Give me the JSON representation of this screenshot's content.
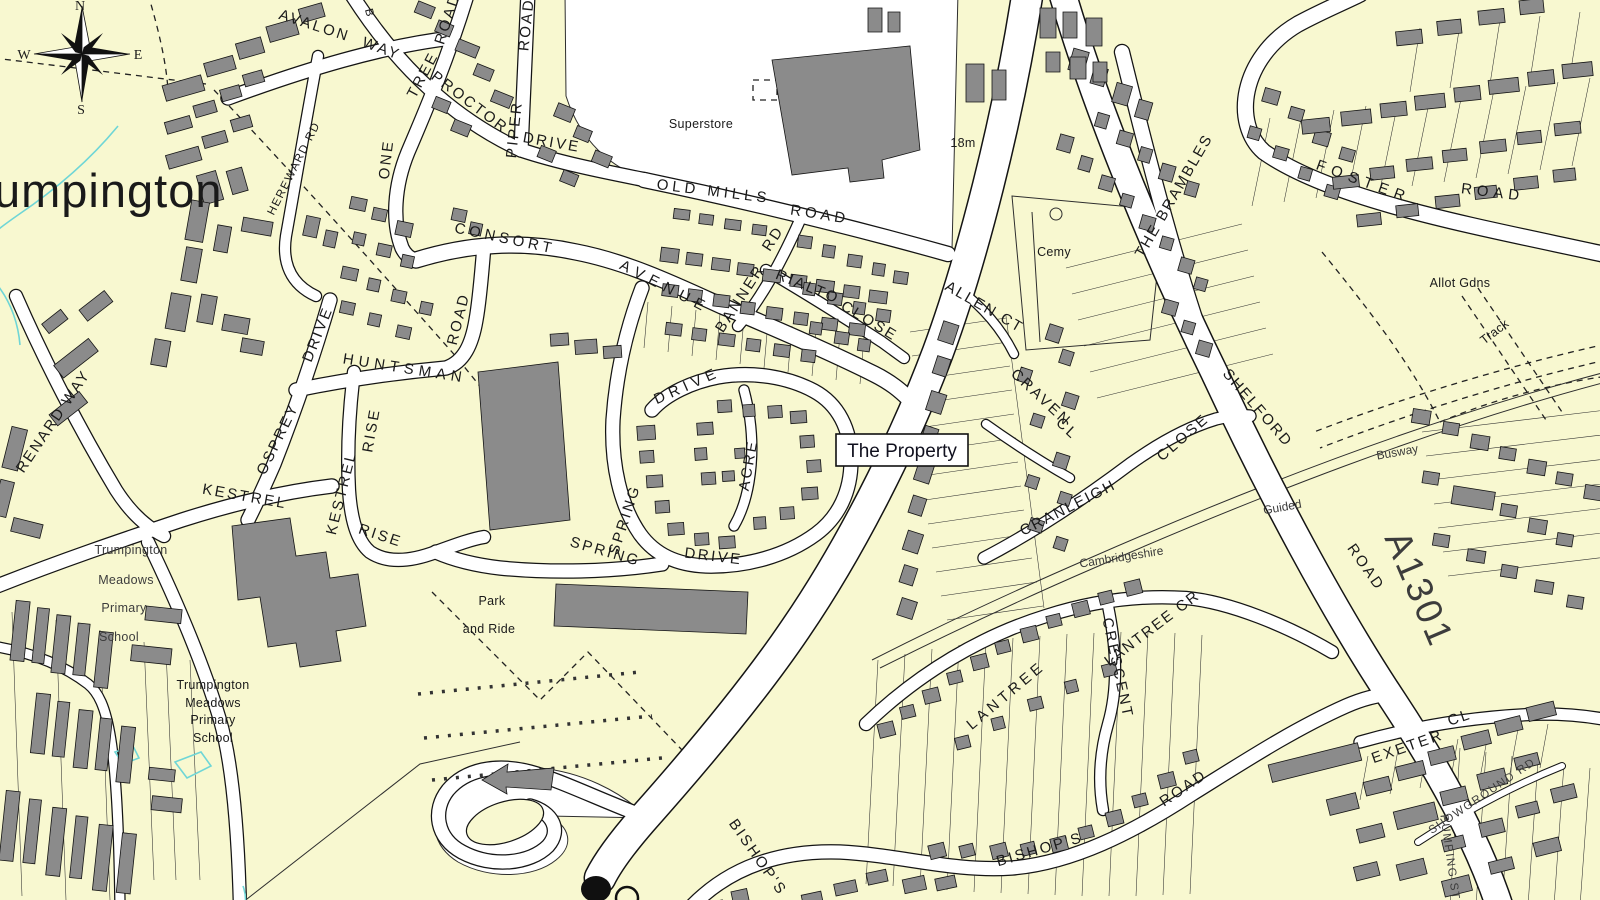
{
  "colors": {
    "land": "#F8F8D0",
    "road": "#FFFFFF",
    "casing": "#141414",
    "building": "#8B8B8B",
    "water": "#6FD6D6",
    "label": "#1A1A1A"
  },
  "labels": {
    "place": "umpington",
    "compass_n": "N",
    "compass_e": "E",
    "compass_s": "S",
    "compass_w": "W",
    "avalon": "AVALON",
    "avalon_way": "WAY",
    "b_partial": "B",
    "onetree_road": "ROAD",
    "onetree_tree": "TREE",
    "onetree_one": "ONE",
    "proctor": "PROCTOR",
    "piper_road": "ROAD",
    "piper": "PIPER",
    "piper_drive": "DRIVE",
    "hereward": "HEREWARD RD",
    "consort": "CONSORT",
    "consort_avenue": "AVENUE",
    "oldmills": "OLD MILLS",
    "oldmills_road": "ROAD",
    "banner": "BANNER",
    "banner_rd": "RD",
    "rialto": "RIALTO",
    "rialto_close": "CLOSE",
    "huntsman": "HUNTSMAN",
    "huntsman_road": "ROAD",
    "osprey": "OSPREY",
    "osprey_drive": "DRIVE",
    "renard": "RENARD WAY",
    "kestrel_h": "KESTREL",
    "kestrel_v": "KESTREL",
    "rise_n": "RISE",
    "rise_s": "RISE",
    "drive_loop": "DRIVE",
    "acre": "ACRE",
    "spring_v": "SPRING",
    "spring_d": "SPRING",
    "spring_drive": "DRIVE",
    "property": "The Property",
    "allen_ct": "ALLEN CT",
    "craven": "CRAVEN",
    "craven_cl": "CL",
    "cranleigh": "CRANLEIGH",
    "cranleigh_close": "CLOSE",
    "brambles": "THE BRAMBLES",
    "foster": "FOSTER",
    "foster_road": "ROAD",
    "shelford": "SHELFORD",
    "shelford_road": "ROAD",
    "a1301": "A1301",
    "busway": "Busway",
    "guided": "Guided",
    "cambridgeshire": "Cambridgeshire",
    "lantree": "LANTREE",
    "crescent": "CRESCENT",
    "lantree_cr": "LANTREE CR",
    "bishops": "BISHOP'S",
    "bishops_road": "ROAD",
    "bishops_w": "BISHOP'S",
    "exeter": "EXETER",
    "exeter_cl": "CL",
    "showground": "SHOWGROUND RD",
    "pumping": "PUMPING STA",
    "superstore": "Superstore",
    "cemy": "Cemy",
    "allot": "Allot Gdns",
    "track": "Track",
    "spot_18m": "18m",
    "park": "Park",
    "and_ride": "and Ride",
    "school_f1": "Trumpington",
    "school_f2": "Meadows",
    "school_f3": "Primary",
    "school_f4": "School",
    "school_1": "Trumpington",
    "school_2": "Meadows",
    "school_3": "Primary",
    "school_4": "School"
  }
}
